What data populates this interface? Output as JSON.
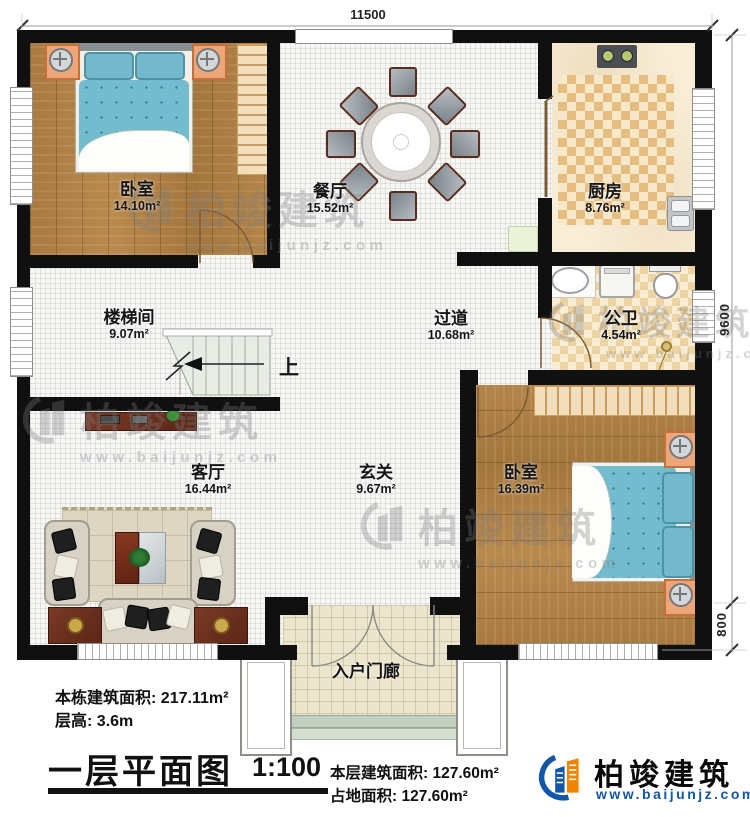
{
  "plan": {
    "dimensions": {
      "width_top": "11500",
      "height_right": "9600",
      "porch_depth": "800"
    },
    "rooms": {
      "bedroom1": {
        "name": "卧室",
        "area": "14.10m²"
      },
      "dining": {
        "name": "餐厅",
        "area": "15.52m²"
      },
      "kitchen": {
        "name": "厨房",
        "area": "8.76m²"
      },
      "stairwell": {
        "name": "楼梯间",
        "area": "9.07m²"
      },
      "hallway": {
        "name": "过道",
        "area": "10.68m²"
      },
      "bathroom": {
        "name": "公卫",
        "area": "4.54m²"
      },
      "living": {
        "name": "客厅",
        "area": "16.44m²"
      },
      "foyer": {
        "name": "玄关",
        "area": "9.67m²"
      },
      "bedroom2": {
        "name": "卧室",
        "area": "16.39m²"
      },
      "porch": {
        "name": "入户门廊"
      }
    },
    "stairs_up_label": "上"
  },
  "notes": {
    "building_area_label": "本栋建筑面积:",
    "building_area": "217.11m²",
    "floor_height_label": "层高:",
    "floor_height": "3.6m"
  },
  "title_block": {
    "title": "一层平面图",
    "scale": "1:100",
    "floor_area_label": "本层建筑面积:",
    "floor_area": "127.60m²",
    "land_area_label": "占地面积:",
    "land_area": "127.60m²"
  },
  "brand": {
    "name": "柏竣建筑",
    "url": "www.baijunjz.com"
  },
  "watermark": {
    "name": "柏竣建筑",
    "url": "www.baijunjz.com"
  },
  "colors": {
    "wall": "#101010",
    "wood_floor": "#ac7e45",
    "bed_blue": "#72bccd",
    "kitchen_tile": "#e6bd80",
    "brand_blue": "#1256a8",
    "brand_orange": "#f08300"
  }
}
